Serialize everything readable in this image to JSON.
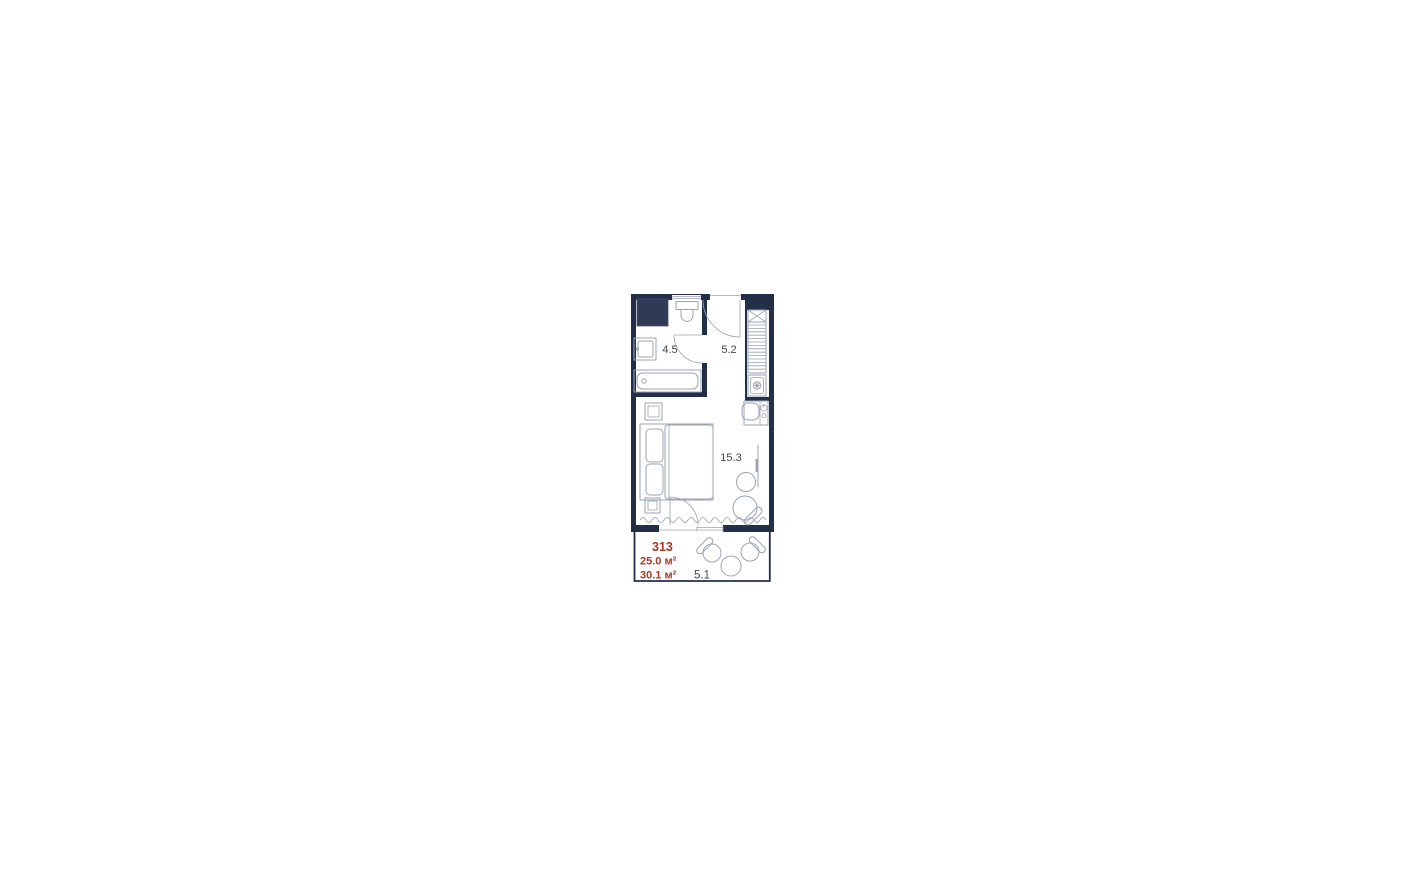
{
  "unit": {
    "number": "313",
    "area_main": "25.0 м²",
    "area_total": "30.1 м²"
  },
  "rooms": {
    "bathroom": {
      "label": "4.5"
    },
    "hallway": {
      "label": "5.2"
    },
    "living": {
      "label": "15.3"
    },
    "balcony": {
      "label": "5.1"
    }
  },
  "colors": {
    "wall": "#232e49",
    "shaft_fill": "#2e3a56",
    "furniture_line": "#9aa3b4",
    "label_text": "#3f4654",
    "accent": "#a23c28"
  }
}
